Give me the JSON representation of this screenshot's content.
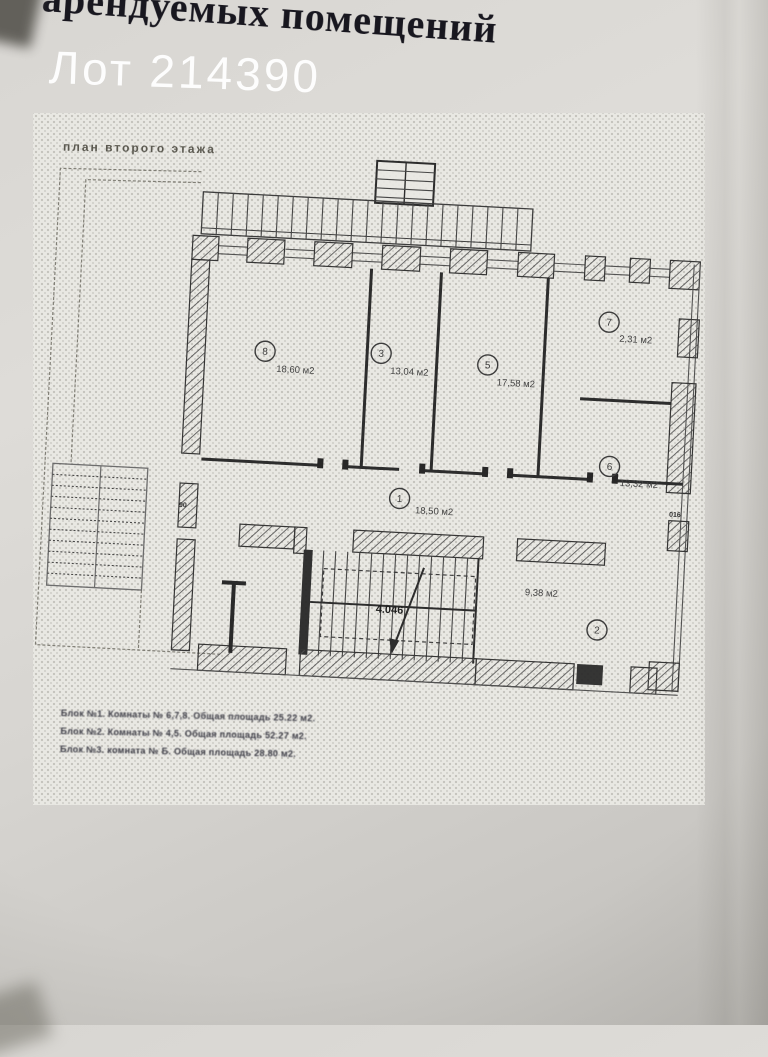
{
  "photo": {
    "header_title": "арендуемых помещений",
    "lot_label": "Лот 214390"
  },
  "plan": {
    "caption": "план второго этажа",
    "stair_dimension_label": "4.046",
    "door_width_label_left": "90",
    "door_width_label_right": "016",
    "rooms": [
      {
        "number": "8",
        "area_label": "18,60 м2"
      },
      {
        "number": "3",
        "area_label": "13,04 м2"
      },
      {
        "number": "5",
        "area_label": "17,58 м2"
      },
      {
        "number": "7",
        "area_label": "2,31 м2"
      },
      {
        "number": "6",
        "area_label": "13,32 м2"
      },
      {
        "number": "1",
        "area_label": "18,50 м2"
      },
      {
        "number": "2",
        "area_label": "9,38 м2"
      }
    ],
    "legend": {
      "lines": [
        "Блок №1. Комнаты № 6,7,8. Общая площадь 25.22 м2.",
        "Блок №2. Комнаты № 4,5. Общая площадь 52.27 м2.",
        "Блок №3. комната № Б. Общая площадь 28.80 м2."
      ]
    }
  },
  "colors": {
    "paper": "#d8d6d2",
    "sheet": "#e9e8e3",
    "ink": "#222222",
    "watermark_text": "#ffffff"
  }
}
